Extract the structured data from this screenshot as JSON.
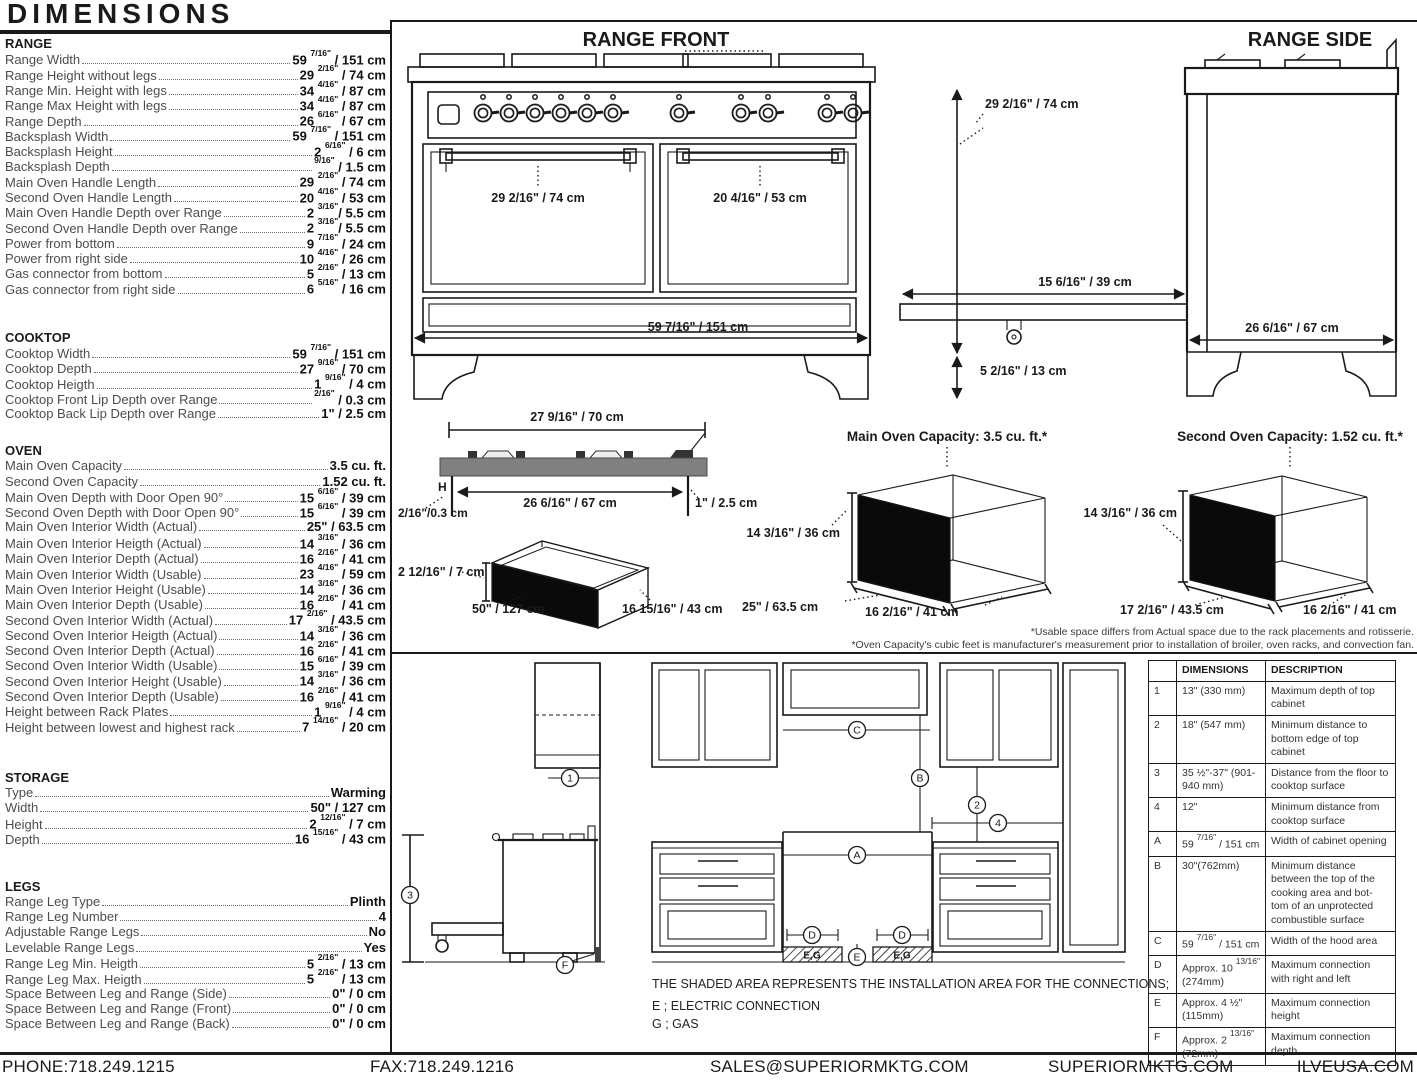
{
  "page": {
    "title": "DIMENSIONS"
  },
  "specs": {
    "sections": [
      {
        "name": "RANGE",
        "rows": [
          {
            "label": "Range Width",
            "value": "59 7/16\" / 151 cm"
          },
          {
            "label": "Range Height without legs",
            "value": "29 2/16\" / 74 cm"
          },
          {
            "label": "Range Min. Height with legs",
            "value": "34 4/16\" / 87 cm"
          },
          {
            "label": "Range Max Height with legs",
            "value": "34 4/16\" / 87 cm"
          },
          {
            "label": "Range Depth",
            "value": "26 6/16\" / 67 cm"
          },
          {
            "label": "Backsplash Width",
            "value": "59 7/16\" / 151 cm"
          },
          {
            "label": "Backsplash Height",
            "value": "2 6/16\" / 6 cm"
          },
          {
            "label": "Backsplash Depth",
            "value": "9/16\" / 1.5 cm"
          },
          {
            "label": "Main Oven Handle Length",
            "value": "29 2/16\" / 74 cm"
          },
          {
            "label": "Second Oven Handle Length",
            "value": "20 4/16\" / 53 cm"
          },
          {
            "label": "Main Oven Handle Depth over Range",
            "value": "2 3/16\"/ 5.5 cm"
          },
          {
            "label": "Second Oven Handle Depth over Range",
            "value": "2 3/16\"/ 5.5 cm"
          },
          {
            "label": "Power from bottom",
            "value": "9 7/16\" / 24 cm"
          },
          {
            "label": "Power from right side",
            "value": "10 4/16\" / 26 cm"
          },
          {
            "label": "Gas connector from bottom",
            "value": "5 2/16\" / 13 cm"
          },
          {
            "label": "Gas connector from right side",
            "value": "6 5/16\" / 16 cm"
          }
        ]
      },
      {
        "name": "COOKTOP",
        "rows": [
          {
            "label": "Cooktop Width",
            "value": "59 7/16\" / 151 cm"
          },
          {
            "label": "Cooktop Depth",
            "value": "27 9/16\" / 70 cm"
          },
          {
            "label": "Cooktop Heigth",
            "value": "1 9/16\" / 4 cm"
          },
          {
            "label": "Cooktop Front Lip Depth over Range",
            "value": "2/16\" / 0.3 cm"
          },
          {
            "label": "Cooktop Back Lip Depth over Range",
            "value": "1\" / 2.5 cm"
          }
        ]
      },
      {
        "name": "OVEN",
        "rows": [
          {
            "label": "Main Oven Capacity",
            "value": "3.5 cu. ft."
          },
          {
            "label": "Second Oven Capacity",
            "value": "1.52 cu. ft."
          },
          {
            "label": "Main Oven Depth with Door Open 90°",
            "value": "15 6/16\" / 39 cm"
          },
          {
            "label": "Second Oven Depth with Door Open 90°",
            "value": "15 6/16\" / 39 cm"
          },
          {
            "label": "Main Oven Interior Width (Actual)",
            "value": "25\" / 63.5 cm"
          },
          {
            "label": "Main Oven Interior Heigth (Actual)",
            "value": "14 3/16\" / 36 cm"
          },
          {
            "label": "Main Oven Interior Depth (Actual)",
            "value": "16 2/16\" / 41 cm"
          },
          {
            "label": "Main Oven Interior Width (Usable)",
            "value": "23 4/16\" / 59 cm"
          },
          {
            "label": "Main Oven Interior Height (Usable)",
            "value": "14 3/16\" / 36 cm"
          },
          {
            "label": "Main Oven Interior Depth (Usable)",
            "value": "16 2/16\" / 41 cm"
          },
          {
            "label": "Second Oven Interior Width (Actual)",
            "value": "17 2/16\" / 43.5 cm"
          },
          {
            "label": "Second Oven Interior Heigth (Actual)",
            "value": "14 3/16\" / 36 cm"
          },
          {
            "label": "Second Oven Interior Depth (Actual)",
            "value": "16 2/16\" / 41 cm"
          },
          {
            "label": "Second Oven Interior Width (Usable)",
            "value": "15 6/16\" / 39 cm"
          },
          {
            "label": "Second Oven Interior Height (Usable)",
            "value": "14 3/16\" / 36 cm"
          },
          {
            "label": "Second Oven Interior Depth (Usable)",
            "value": "16 2/16\" / 41 cm"
          },
          {
            "label": "Height between Rack Plates",
            "value": "1 9/16\" / 4 cm"
          },
          {
            "label": "Height between lowest and highest rack",
            "value": "7 14/16\" / 20 cm"
          }
        ]
      },
      {
        "name": "STORAGE",
        "rows": [
          {
            "label": "Type",
            "value": "Warming"
          },
          {
            "label": "Width",
            "value": "50\" / 127 cm"
          },
          {
            "label": "Height",
            "value": "2 12/16\" / 7 cm"
          },
          {
            "label": "Depth",
            "value": "16 15/16\" / 43 cm"
          }
        ]
      },
      {
        "name": "LEGS",
        "rows": [
          {
            "label": "Range Leg Type",
            "value": "Plinth"
          },
          {
            "label": "Range Leg Number",
            "value": "4"
          },
          {
            "label": "Adjustable Range Legs",
            "value": "No"
          },
          {
            "label": "Levelable Range Legs",
            "value": "Yes"
          },
          {
            "label": "Range Leg Min. Heigth",
            "value": "5 2/16\" / 13 cm"
          },
          {
            "label": "Range Leg Max. Heigth",
            "value": "5 2/16\" / 13 cm"
          },
          {
            "label": "Space Between Leg and Range (Side)",
            "value": "0\" / 0 cm"
          },
          {
            "label": "Space Between Leg and Range (Front)",
            "value": "0\" / 0 cm"
          },
          {
            "label": "Space Between Leg and Range (Back)",
            "value": "0\" / 0 cm"
          }
        ]
      }
    ]
  },
  "front": {
    "title": "RANGE FRONT",
    "main_handle": "29 2/16\" / 74 cm",
    "second_handle": "20 4/16\" / 53 cm",
    "width": "59 7/16\" / 151 cm"
  },
  "side": {
    "title": "RANGE SIDE",
    "height": "29 2/16\" / 74 cm",
    "leg_height": "5 2/16\" / 13 cm",
    "drawer_ext": "15 6/16\" / 39 cm",
    "depth": "26 6/16\" / 67 cm"
  },
  "cooktop_profile": {
    "top_width": "27 9/16\" / 70 cm",
    "inner_width": "26 6/16\" / 67 cm",
    "front_lip": "2/16\"/0.3 cm",
    "back_lip": "1\" / 2.5 cm",
    "h_label": "H"
  },
  "storage_drawer": {
    "height": "2 12/16\" / 7 cm",
    "width": "50\" / 127 cm",
    "depth": "16 15/16\" / 43 cm"
  },
  "main_oven": {
    "title": "Main Oven Capacity: 3.5 cu. ft.*",
    "height": "14 3/16\" / 36 cm",
    "width": "25\" / 63.5 cm",
    "depth": "16 2/16\" / 41 cm"
  },
  "second_oven": {
    "title": "Second Oven Capacity: 1.52 cu. ft.*",
    "height": "14 3/16\" / 36 cm",
    "width": "17 2/16\" / 43.5 cm",
    "depth": "16 2/16\" / 41 cm"
  },
  "footnotes": {
    "line1": "*Usable space differs from Actual space due to the rack placements and rotisserie.",
    "line2": "*Oven Capacity's cubic feet is manufacturer's measurement prior to installation of broiler, oven racks, and convection fan."
  },
  "installation": {
    "note": "THE SHADED AREA REPRESENTS THE INSTALLATION AREA FOR THE CONNECTIONS;",
    "legend_e": "E ; ELECTRIC CONNECTION",
    "legend_g": "G ; GAS",
    "eg_label": "E,G",
    "labels": {
      "n1": "1",
      "n2": "2",
      "n3": "3",
      "n4": "4",
      "a": "A",
      "b": "B",
      "c": "C",
      "d": "D",
      "e": "E",
      "f": "F"
    },
    "table": {
      "headers": [
        "DIMENSIONS",
        "DESCRIPTION"
      ],
      "rows": [
        {
          "key": "1",
          "dimension": "13\" (330 mm)",
          "description": "Maximum depth of top cabinet"
        },
        {
          "key": "2",
          "dimension": "18\" (547 mm)",
          "description": "Minimum distance to bottom edge of top cabinet"
        },
        {
          "key": "3",
          "dimension": "35 ½\"-37\" (901-940 mm)",
          "description": "Distance from the floor to cooktop surface"
        },
        {
          "key": "4",
          "dimension": "12\"",
          "description": "Minimum distance from cooktop surface"
        },
        {
          "key": "A",
          "dimension": "59 7/16\" / 151 cm",
          "description": "Width of cabinet opening"
        },
        {
          "key": "B",
          "dimension": "30\"(762mm)",
          "description": "Minimum distance between the top of the cooking area and bot-tom of an unprotected combustible surface"
        },
        {
          "key": "C",
          "dimension": "59 7/16\" / 151 cm",
          "description": "Width of the hood area"
        },
        {
          "key": "D",
          "dimension": "Approx. 10 13/16\" (274mm)",
          "description": "Maximum connection with right and left"
        },
        {
          "key": "E",
          "dimension": "Approx. 4 ½\" (115mm)",
          "description": "Maximum connection height"
        },
        {
          "key": "F",
          "dimension": "Approx. 2 13/16\" (72mm)",
          "description": "Maximum connection depth"
        }
      ]
    }
  },
  "footer": {
    "phone": "PHONE:718.249.1215",
    "fax": "FAX:718.249.1216",
    "email": "SALES@SUPERIORMKTG.COM",
    "website": "SUPERIORMKTG.COM",
    "brand_site": "ILVEUSA.COM"
  }
}
